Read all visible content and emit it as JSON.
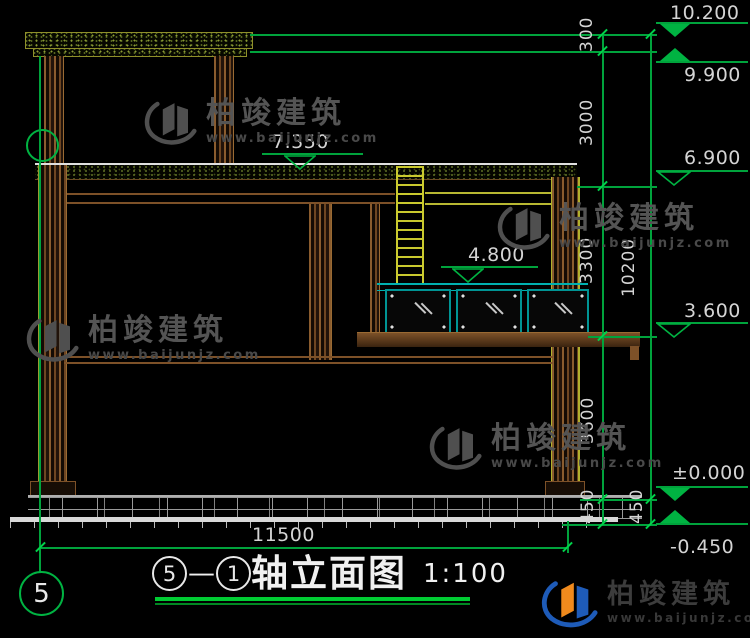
{
  "watermark": {
    "brand": "柏竣建筑",
    "url": "www.baijunjz.com"
  },
  "title": {
    "axis_start": "5",
    "separator": "—",
    "axis_end": "1",
    "name": "轴立面图",
    "scale": "1:100"
  },
  "axis_bubble": {
    "label": "5"
  },
  "levels": {
    "parapet_top": "10.200",
    "parapet_bottom": "9.900",
    "terrace": "7.350",
    "roof": "6.900",
    "balcony_rail": "4.800",
    "floor2": "3.600",
    "ground": "±0.000",
    "site": "-0.450"
  },
  "dimensions": {
    "seg_300": "300",
    "seg_3000": "3000",
    "seg_3300": "3300",
    "seg_3600": "3600",
    "seg_450_inner": "450",
    "seg_450_outer": "450",
    "total_height": "10200",
    "total_width": "11500"
  },
  "colors": {
    "line_green": "#00a33c",
    "wall_brown": "#7d5128",
    "frame_teal": "#009494",
    "detail_yellow": "#c9c92e",
    "text_light": "#d4d4d4",
    "logo_blue": "#1e5bb8",
    "logo_orange": "#f08a1d"
  }
}
